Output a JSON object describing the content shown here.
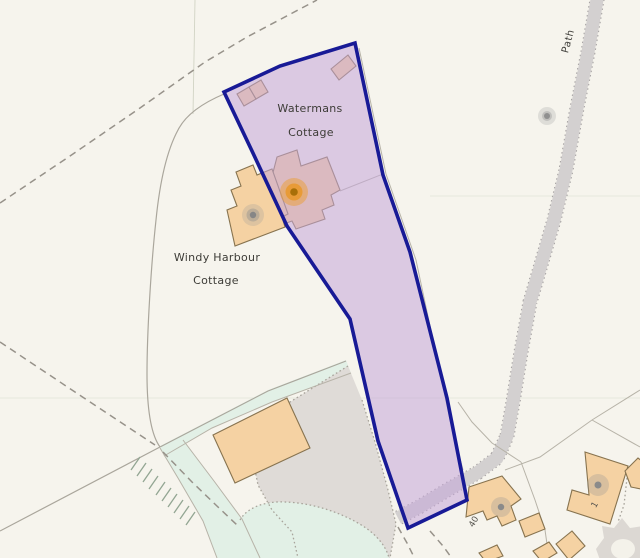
{
  "map": {
    "labels": {
      "property1_line1": "Watermans",
      "property1_line2": "Cottage",
      "property2_line1": "Windy Harbour",
      "property2_line2": "Cottage",
      "path": "Path",
      "house_number_40": "40",
      "house_number_1": "1"
    },
    "colors": {
      "background": "#f6f4ed",
      "parcel_boundary": "#181a96",
      "parcel_fill": "rgba(196,165,216,0.55)",
      "building_fill": "#f5d2a3",
      "building_outline": "#87734f",
      "track": "#d3d0d0",
      "green_area": "#e2f0e6",
      "yard": "#dfdbd7",
      "subject_marker": "#a86f08",
      "poi_marker": "#8a8a8a",
      "label_text": "#3d3c37"
    }
  }
}
